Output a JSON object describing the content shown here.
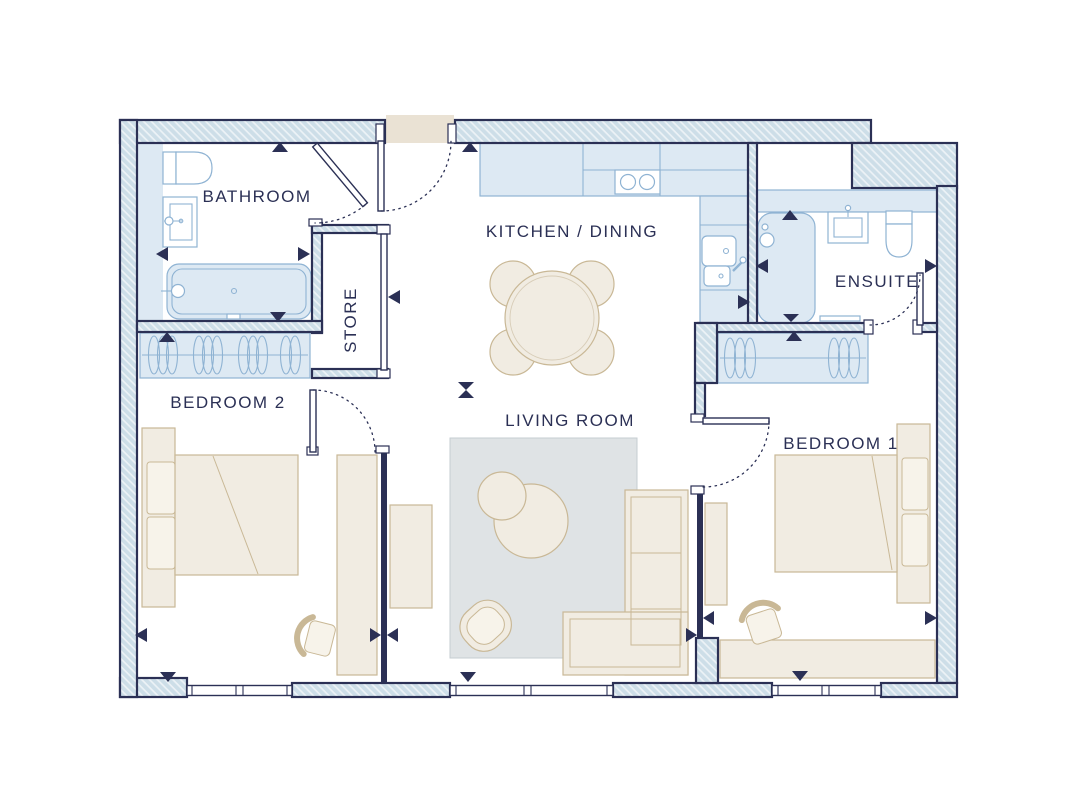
{
  "plan": {
    "rooms": {
      "bathroom": {
        "label": "BATHROOM",
        "fixtures": [
          "toilet-icon",
          "basin-icon",
          "bathtub-icon"
        ]
      },
      "store": {
        "label": "STORE",
        "fixtures": []
      },
      "kitchen_dining": {
        "label": "KITCHEN / DINING",
        "fixtures": [
          "worktop-icon",
          "hob-icon",
          "double-sink-icon",
          "dining-table-icon",
          "dining-chair-icon"
        ]
      },
      "ensuite": {
        "label": "ENSUITE",
        "fixtures": [
          "shower-icon",
          "basin-icon",
          "toilet-icon"
        ]
      },
      "bedroom2": {
        "label": "BEDROOM 2",
        "fixtures": [
          "wardrobe-icon",
          "double-bed-icon",
          "desk-icon",
          "chair-icon"
        ]
      },
      "living_room": {
        "label": "LIVING ROOM",
        "fixtures": [
          "rug-icon",
          "coffee-table-icon",
          "armchair-icon",
          "corner-sofa-icon",
          "sideboard-icon"
        ]
      },
      "bedroom1": {
        "label": "BEDROOM 1",
        "fixtures": [
          "wardrobe-icon",
          "double-bed-icon",
          "desk-icon",
          "chair-icon",
          "tv-unit-icon"
        ]
      }
    },
    "colors": {
      "wall_fill": "#cddee8",
      "wall_line": "#2b3055",
      "fixture_fill": "#dde9f3",
      "fixture_line": "#8fb3d3",
      "furniture_fill": "#f1ece2",
      "furniture_line": "#c9b896",
      "rug_fill": "#dfe3e5",
      "text_color": "#2b3055",
      "entrance_mat_fill": "#eae2d4"
    }
  }
}
